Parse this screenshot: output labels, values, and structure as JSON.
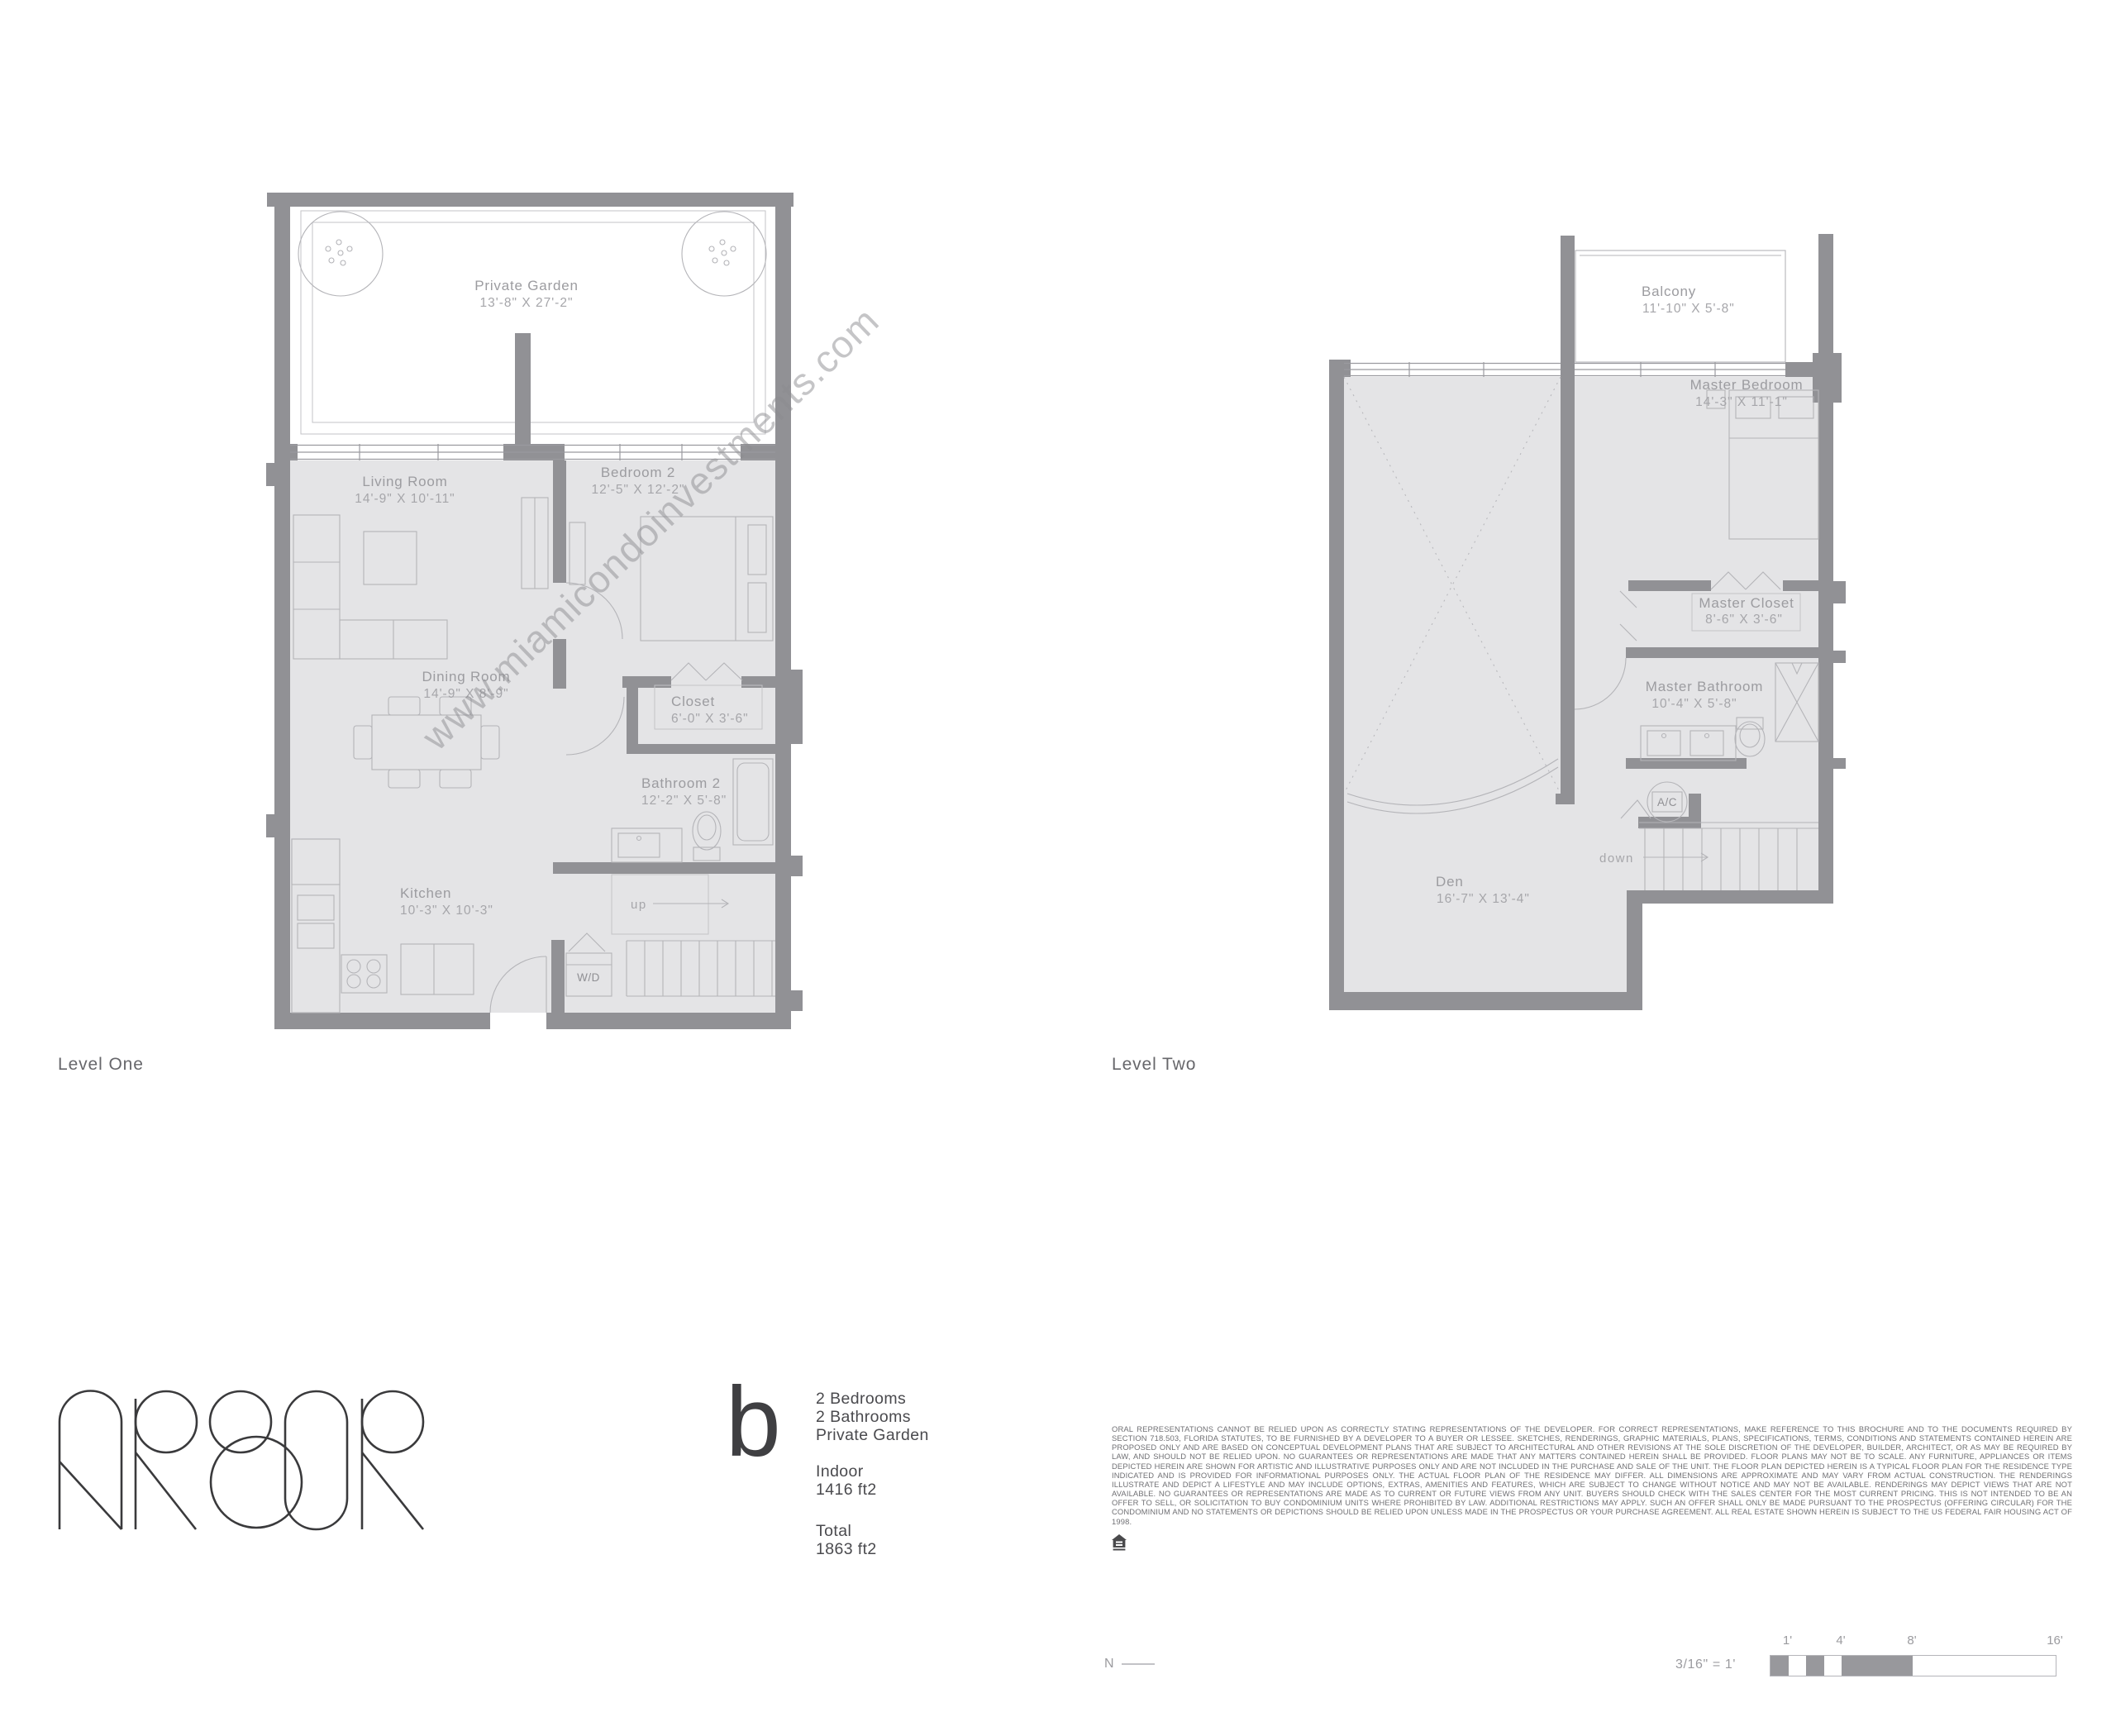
{
  "watermark": "www.miamicondoinvestments.com",
  "brand": {
    "name": "ARBOR"
  },
  "colors": {
    "wall": "#919195",
    "room_fill": "#e4e4e6",
    "thin_line": "#b4b4b8",
    "room_label": "#9c9ca0",
    "text_dark": "#4a4a4e",
    "disclaimer": "#707074"
  },
  "levels": {
    "one": {
      "caption": "Level One",
      "rooms": [
        {
          "name": "Private Garden",
          "dim": "13'-8\" X 27'-2\""
        },
        {
          "name": "Living Room",
          "dim": "14'-9\" X 10'-11\""
        },
        {
          "name": "Bedroom 2",
          "dim": "12'-5\" X 12'-2\""
        },
        {
          "name": "Dining Room",
          "dim": "14'-9\" X 8'-9\""
        },
        {
          "name": "Closet",
          "dim": "6'-0\" X 3'-6\""
        },
        {
          "name": "Bathroom 2",
          "dim": "12'-2\" X 5'-8\""
        },
        {
          "name": "Kitchen",
          "dim": "10'-3\" X 10'-3\""
        }
      ],
      "labels": {
        "wd": "W/D",
        "up": "up"
      }
    },
    "two": {
      "caption": "Level Two",
      "rooms": [
        {
          "name": "Balcony",
          "dim": "11'-10\" X 5'-8\""
        },
        {
          "name": "Master Bedroom",
          "dim": "14'-3\" X 11'-1\""
        },
        {
          "name": "Master Closet",
          "dim": "8'-6\" X 3'-6\""
        },
        {
          "name": "Master Bathroom",
          "dim": "10'-4\" X 5'-8\""
        },
        {
          "name": "Den",
          "dim": "16'-7\" X 13'-4\""
        }
      ],
      "labels": {
        "ac": "A/C",
        "down": "down"
      }
    }
  },
  "unit": {
    "letter": "b",
    "features": [
      "2 Bedrooms",
      "2 Bathrooms",
      "Private Garden"
    ],
    "indoor_label": "Indoor",
    "indoor_value": "1416 ft2",
    "total_label": "Total",
    "total_value": "1863 ft2"
  },
  "disclaimer": "ORAL REPRESENTATIONS CANNOT BE RELIED UPON AS CORRECTLY STATING REPRESENTATIONS OF THE DEVELOPER. FOR CORRECT REPRESENTATIONS, MAKE REFERENCE TO THIS BROCHURE AND TO THE DOCUMENTS REQUIRED BY SECTION 718.503, FLORIDA STATUTES, TO BE FURNISHED BY A DEVELOPER TO A BUYER OR LESSEE.  SKETCHES, RENDERINGS, GRAPHIC MATERIALS, PLANS, SPECIFICATIONS, TERMS, CONDITIONS AND STATEMENTS CONTAINED HEREIN ARE PROPOSED ONLY AND ARE BASED ON CONCEPTUAL DEVELOPMENT PLANS THAT ARE SUBJECT TO ARCHITECTURAL AND OTHER REVISIONS AT THE SOLE DISCRETION OF THE DEVELOPER, BUILDER, ARCHITECT, OR AS MAY BE REQUIRED BY LAW, AND SHOULD NOT BE RELIED UPON. NO GUARANTEES OR REPRESENTATIONS ARE MADE THAT ANY MATTERS CONTAINED HEREIN SHALL BE PROVIDED. FLOOR PLANS MAY NOT BE TO SCALE. ANY FURNITURE, APPLIANCES OR ITEMS DEPICTED HEREIN ARE SHOWN FOR ARTISTIC AND ILLUSTRATIVE PURPOSES ONLY AND ARE NOT INCLUDED IN THE PURCHASE AND SALE OF THE UNIT. THE FLOOR PLAN DEPICTED HEREIN IS A TYPICAL FLOOR PLAN FOR THE RESIDENCE TYPE INDICATED AND IS PROVIDED FOR INFORMATIONAL PURPOSES ONLY. THE ACTUAL FLOOR PLAN OF THE RESIDENCE MAY DIFFER.  ALL DIMENSIONS ARE APPROXIMATE AND MAY VARY FROM ACTUAL CONSTRUCTION. THE RENDERINGS ILLUSTRATE AND DEPICT A LIFESTYLE AND MAY INCLUDE OPTIONS, EXTRAS, AMENITIES AND FEATURES, WHICH ARE SUBJECT TO CHANGE WITHOUT NOTICE AND MAY NOT BE AVAILABLE. RENDERINGS MAY DEPICT VIEWS THAT ARE NOT AVAILABLE. NO GUARANTEES OR REPRESENTATIONS ARE MADE AS TO CURRENT OR FUTURE VIEWS FROM ANY UNIT. BUYERS SHOULD CHECK WITH THE SALES CENTER FOR THE MOST CURRENT PRICING. THIS IS NOT INTENDED TO BE AN OFFER TO SELL, OR SOLICITATION TO BUY CONDOMINIUM UNITS WHERE PROHIBITED BY LAW. ADDITIONAL RESTRICTIONS MAY APPLY. SUCH AN OFFER SHALL ONLY BE MADE PURSUANT TO THE PROSPECTUS (OFFERING CIRCULAR) FOR THE CONDOMINIUM AND NO STATEMENTS OR DEPICTIONS SHOULD BE RELIED UPON UNLESS MADE IN THE PROSPECTUS OR YOUR PURCHASE AGREEMENT.  ALL REAL ESTATE SHOWN HEREIN IS SUBJECT TO THE US FEDERAL FAIR HOUSING ACT OF 1998.",
  "footer": {
    "north_label": "N",
    "scale_label": "3/16\" = 1'",
    "scale_ticks": [
      "1'",
      "4'",
      "8'",
      "16'"
    ]
  }
}
